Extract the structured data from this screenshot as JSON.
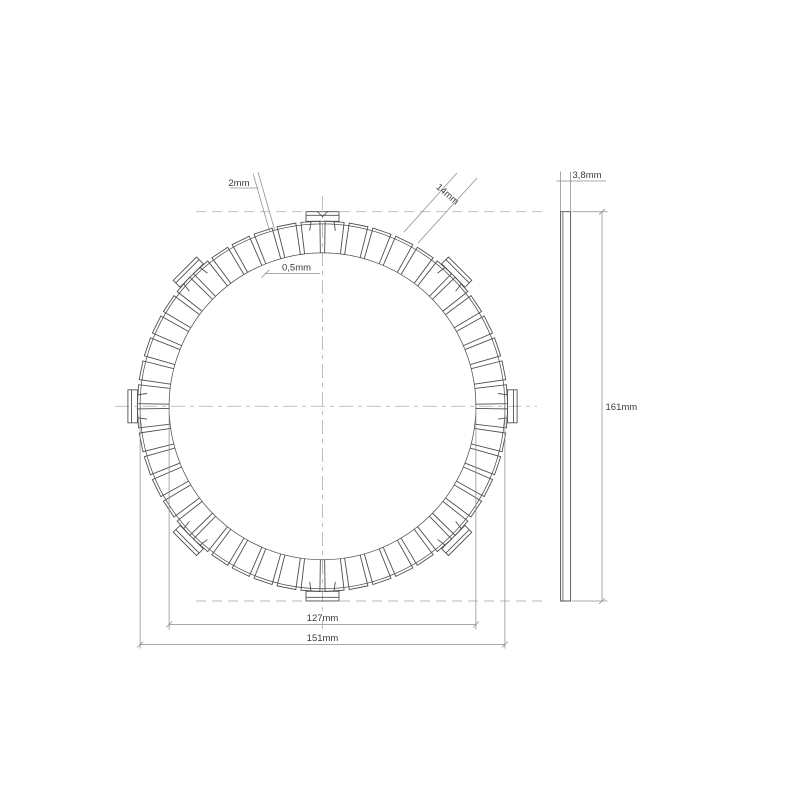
{
  "drawing": {
    "title": "clutch friction disc plate technical drawing",
    "views": {
      "front": "friction plate front view with pads and drive tabs",
      "side": "plate edge profile view"
    },
    "dimensions": {
      "groove_width": "2mm",
      "step": "0,5mm",
      "pad_width": "14mm",
      "friction_inner_diameter": "127mm",
      "friction_outer_diameter": "151mm",
      "overall_diameter": "161mm",
      "thickness": "3,8mm"
    },
    "geometry": {
      "pad_count": 48,
      "tab_count": 8
    },
    "colors": {
      "background": "#ffffff",
      "outline": "#4f4f4f",
      "dimension": "#8c8c8c",
      "centerline": "#b9b9b9",
      "text": "#3a3a3a"
    }
  }
}
